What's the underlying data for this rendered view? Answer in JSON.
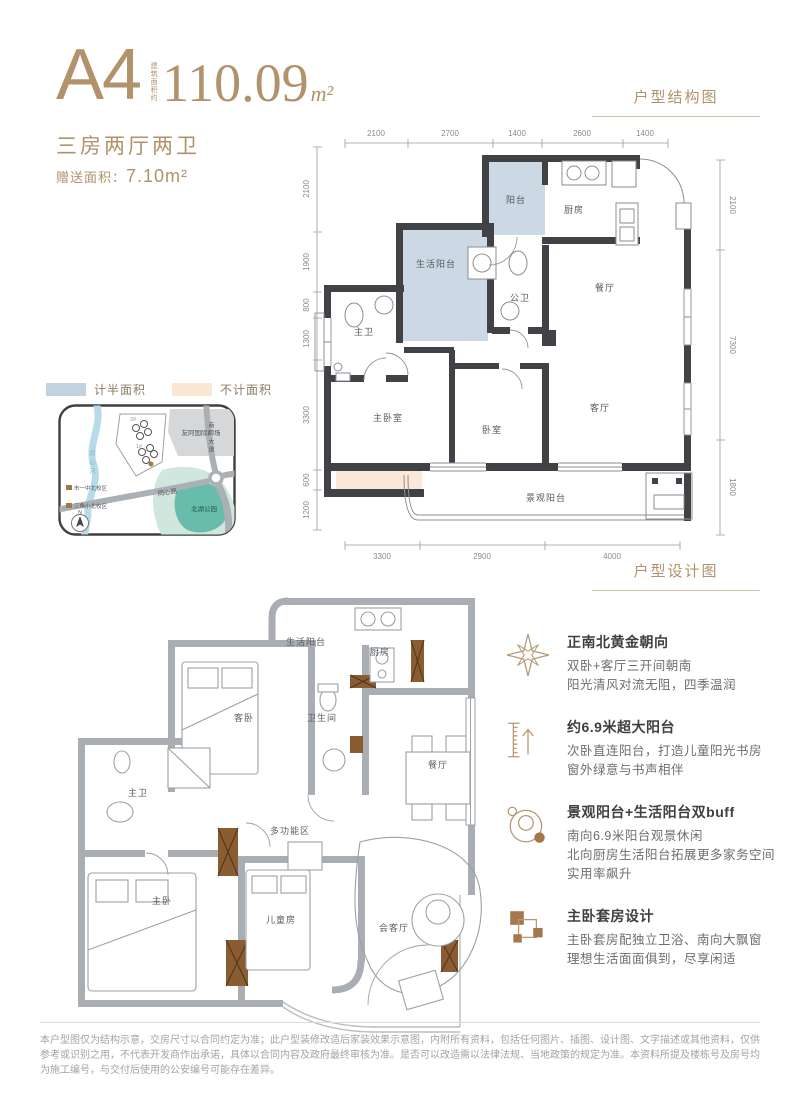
{
  "page": {
    "unit_label": "A4",
    "area_note_vertical": "建筑面积约",
    "area_value": "110.09",
    "area_unit": "m²",
    "layout_type": "三房两厅两卫",
    "bonus_area_label": "赠送面积：",
    "bonus_area_value": "7.10m²",
    "section1_title": "户型结构图",
    "section2_title": "户型设计图"
  },
  "legend": {
    "half_area": {
      "label": "计半面积",
      "color": "#c3d2df"
    },
    "excluded_area": {
      "label": "不计面积",
      "color": "#fbe5d3"
    }
  },
  "map": {
    "river": "同心河",
    "road_vertical": "南岭大道",
    "road_diagonal": "同心路",
    "mall": "友阿国际广场",
    "park": "北湖公园",
    "school1": "市一中北校区",
    "school2": "三角小北校区",
    "plot_a": "2#",
    "plot_b": "1#",
    "compass": "N"
  },
  "plan_structure": {
    "rooms": {
      "balcony": "阳台",
      "kitchen": "厨房",
      "service_balcony": "生活阳台",
      "public_bath": "公卫",
      "dining": "餐厅",
      "master_bath": "主卫",
      "master_bedroom": "主卧室",
      "bedroom": "卧室",
      "living": "客厅",
      "view_balcony": "景观阳台"
    },
    "dims_top": [
      "2100",
      "2700",
      "1400",
      "2600",
      "1400"
    ],
    "dims_left": [
      "2100",
      "1900",
      "800",
      "1300",
      "3300",
      "600",
      "1200"
    ],
    "dims_right": [
      "2100",
      "7300",
      "1800"
    ],
    "dims_bottom": [
      "3300",
      "2900",
      "4000"
    ]
  },
  "plan_design": {
    "rooms": {
      "service_balcony": "生活阳台",
      "kitchen": "厨房",
      "guest_bedroom": "客卧",
      "bathroom": "卫生间",
      "master_bath": "主卫",
      "dining": "餐厅",
      "multi_zone": "多功能区",
      "master_bedroom": "主卧",
      "kids_room": "儿童房",
      "reception": "会客厅"
    }
  },
  "features": [
    {
      "title": "正南北黄金朝向",
      "lines": [
        "双卧+客厅三开间朝南",
        "阳光清风对流无阻，四季温润"
      ]
    },
    {
      "title": "约6.9米超大阳台",
      "lines": [
        "次卧直连阳台，打造儿童阳光书房",
        "窗外绿意与书声相伴"
      ]
    },
    {
      "title": "景观阳台+生活阳台双buff",
      "lines": [
        "南向6.9米阳台观景休闲",
        "北向厨房生活阳台拓展更多家务空间",
        "实用率飙升"
      ]
    },
    {
      "title": "主卧套房设计",
      "lines": [
        "主卧套房配独立卫浴、南向大飘窗",
        "理想生活面面俱到，尽享闲适"
      ]
    }
  ],
  "disclaimer": "本户型图仅为结构示意，交房尺寸以合同约定为准；此户型装修改造后家装效果示意图，内附所有资料，包括任何图片、插图、设计图、文字描述或其他资料，仅供参考或识别之用，不代表开发商作出承诺，具体以合同内容及政府最终审核为准。是否可以改造需以法律法规、当地政策的规定为准。本资料所提及楼栋号及房号均为施工编号，与交付后使用的公安编号可能存在差异。",
  "colors": {
    "gold": "#b1926a",
    "wall_dark": "#414246",
    "wall_gray": "#a9aeb4",
    "half_area_blue": "#ccd8e3",
    "excluded_peach": "#fce8d7",
    "wood_brown": "#8a5c32"
  }
}
